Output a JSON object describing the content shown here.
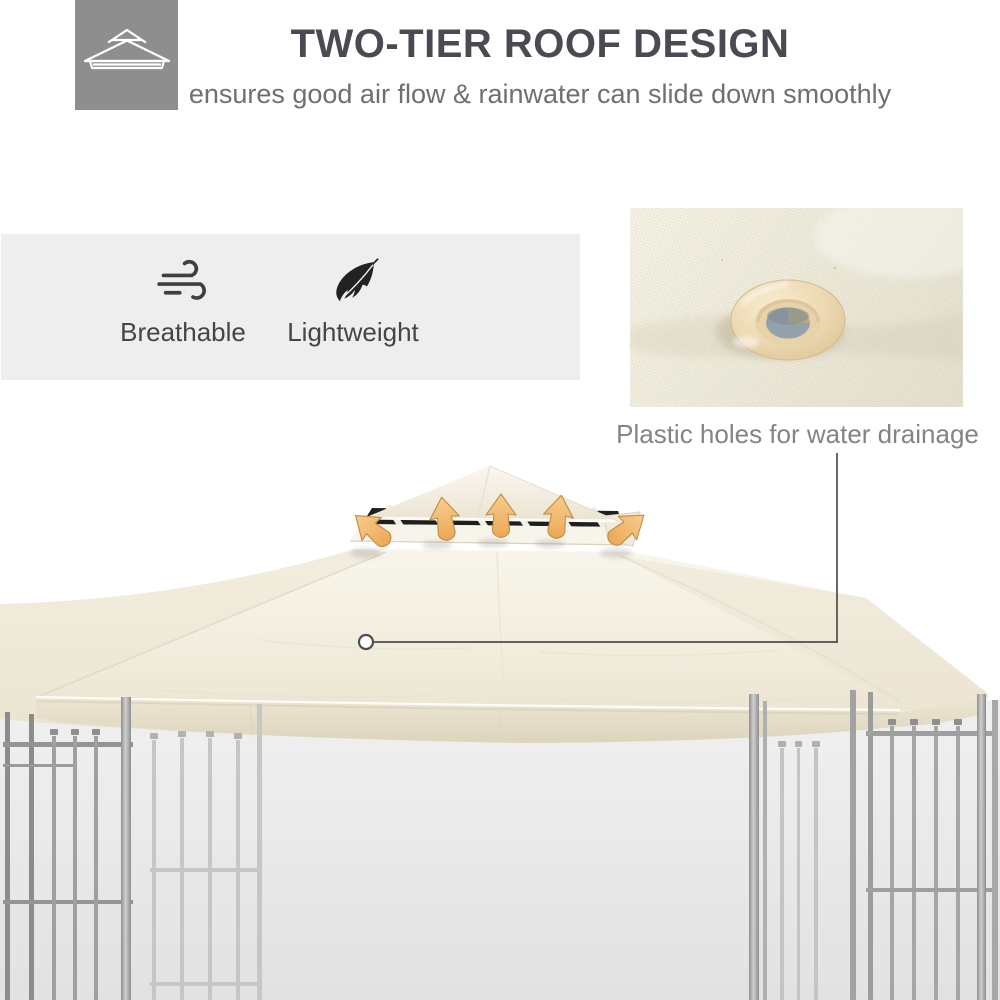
{
  "header": {
    "icon_tile": {
      "icon": "two-tier-roof-icon"
    },
    "title": "TWO-TIER ROOF DESIGN",
    "subtitle": "ensures good air flow & rainwater can slide down smoothly"
  },
  "features": {
    "items": [
      {
        "icon": "wind-icon",
        "label": "Breathable"
      },
      {
        "icon": "feather-icon",
        "label": "Lightweight"
      }
    ]
  },
  "detail_callout": {
    "caption": "Plastic holes for water drainage",
    "inset_image": "canopy-fabric-drainage-grommet-closeup"
  },
  "illustration": {
    "subject": "two-tier gazebo canopy on steel lattice frame",
    "airflow_arrow_count": 5
  },
  "colors": {
    "page-bg": "#ffffff",
    "title": "#4a4b52",
    "subtitle": "#6f6f6f",
    "icon-tile-bg": "#8e8e8e",
    "feature-box-bg": "#eeeeef",
    "feature-label": "#454545",
    "caption": "#848484",
    "canopy-cream": "#f6f3e9",
    "canopy-shade": "#eae3d1",
    "valance": "#e9e2cf",
    "vent-dark": "#201f1d",
    "arrow-fill": "#f3c07c",
    "arrow-edge": "#c08c46",
    "frame-steel": "#a5a5a5",
    "connector": "#4d4d4d",
    "backdrop-top": "#f0f0f0",
    "backdrop-bottom": "#e2e2e2"
  }
}
